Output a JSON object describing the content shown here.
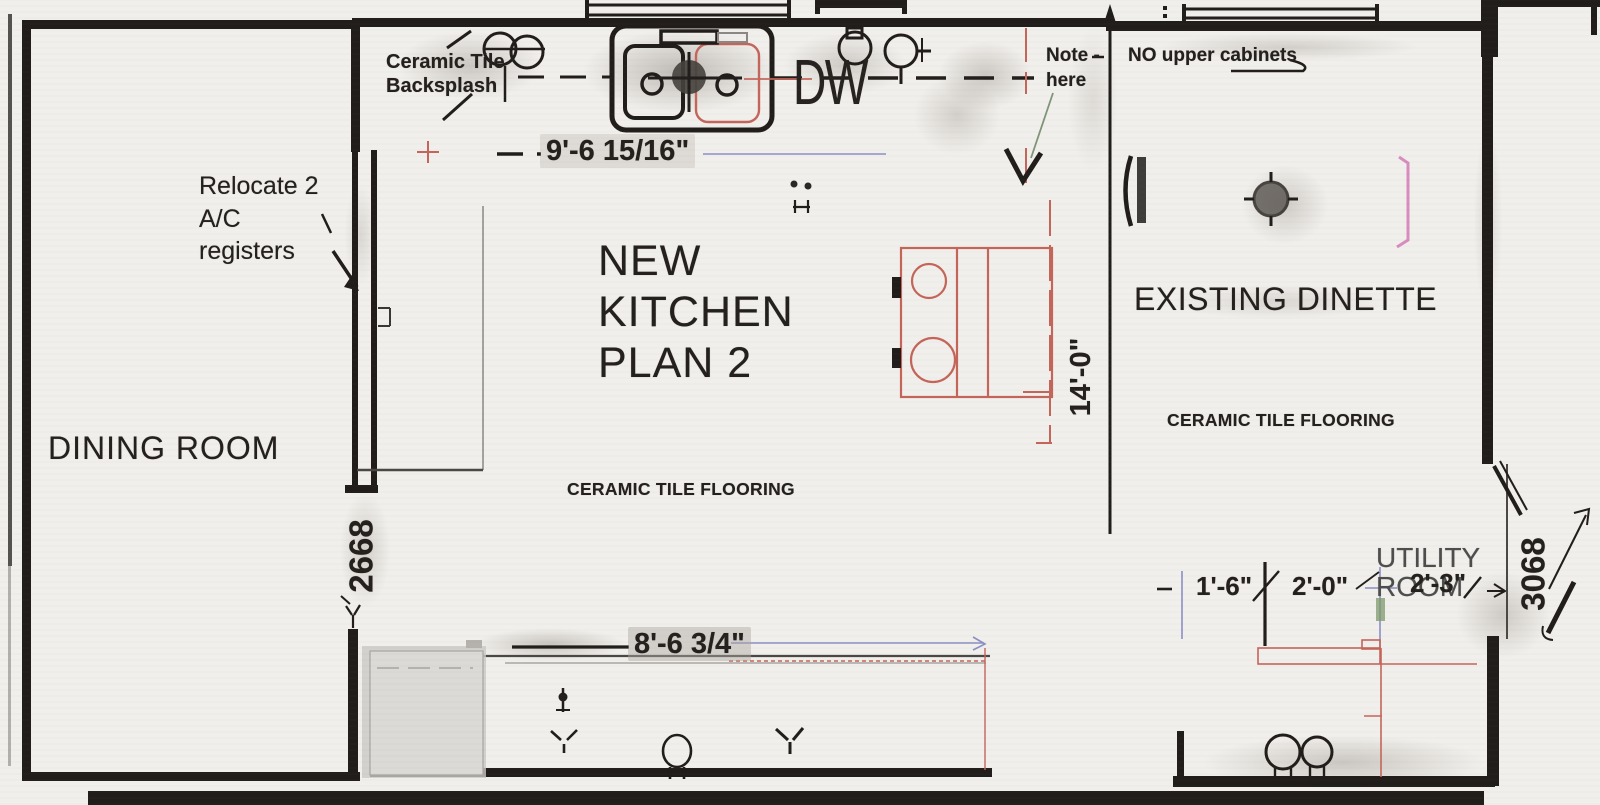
{
  "plan": {
    "title": "NEW\nKITCHEN\nPLAN 2",
    "rooms": {
      "dining": "DINING ROOM",
      "dinette": "EXISTING DINETTE",
      "utility": "UTILITY\nROOM"
    },
    "flooring": {
      "kitchen": "CERAMIC TILE FLOORING",
      "dinette": "CERAMIC TILE FLOORING"
    },
    "annotations": {
      "backsplash": "Ceramic Tile\nBacksplash",
      "relocate_ac": "Relocate 2\nA/C\nregisters",
      "note_here": "Note -\nhere",
      "no_upper_cabinets": "NO upper cabinets",
      "dishwasher": "DW"
    },
    "dimensions": {
      "counter_run": "9'-6 15/16\"",
      "kitchen_depth": "14'-0\"",
      "island_run": "8'-6 3/4\"",
      "utility_seg_1": "1'-6\"",
      "utility_seg_2": "2'-0\"",
      "utility_seg_3": "2'-3\"",
      "door_dining": "2668",
      "door_utility": "3068"
    },
    "colors": {
      "paper": "#f1efeb",
      "wall": "#201d1a",
      "appliance_red": "#c4655a",
      "dimension_blue": "#8a8fc4",
      "accent_pink": "#d98cc0",
      "accent_green": "#7d9a6d"
    }
  }
}
